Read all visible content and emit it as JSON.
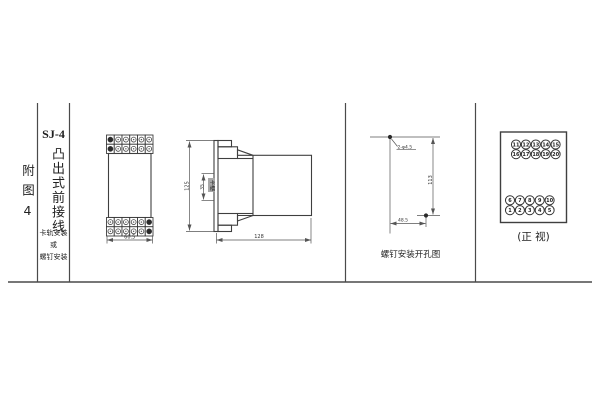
{
  "page": {
    "background": "#ffffff",
    "line_color": "#4a4a4a",
    "text_color": "#222222"
  },
  "sidebar": {
    "figure_label": "附图4",
    "model": "SJ-4",
    "type_text": "凸出式前接线",
    "mount_note": {
      "line1": "卡轨安装",
      "line2": "或",
      "line3": "螺钉安装"
    }
  },
  "figures": {
    "terminal_front": {
      "width_dim": "60.5"
    },
    "side": {
      "height_dim": "125",
      "slot_dim": "35",
      "slot_label": "卡槽",
      "depth_dim": "128"
    },
    "drill": {
      "holes_label": "2-φ4.5",
      "v_dim": "113",
      "h_dim": "48.5",
      "caption": "螺钉安装开孔图"
    },
    "front": {
      "caption": "(正 视)",
      "top_row1": [
        "11",
        "12",
        "13",
        "14",
        "15"
      ],
      "top_row2": [
        "16",
        "17",
        "18",
        "19",
        "20"
      ],
      "bottom_row1": [
        "6",
        "7",
        "8",
        "9",
        "10"
      ],
      "bottom_row2": [
        "1",
        "2",
        "3",
        "4",
        "5"
      ]
    }
  }
}
